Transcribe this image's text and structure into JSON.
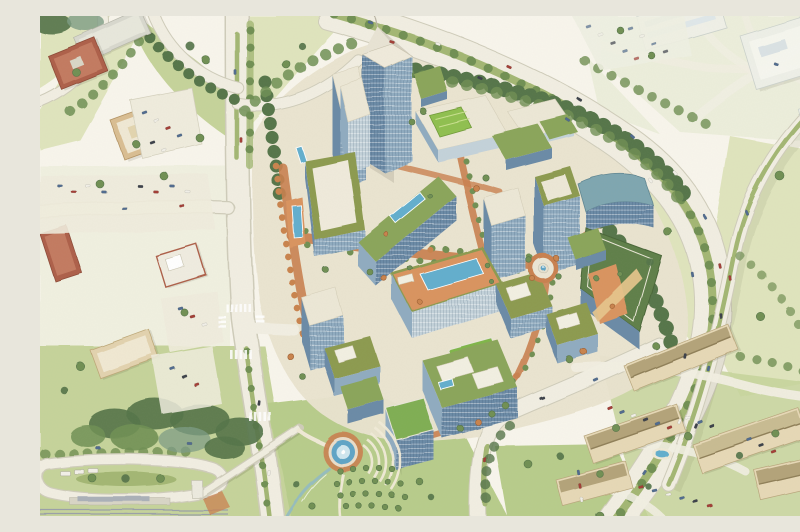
{
  "scene": {
    "title": "Watercolor aerial rendering of a mixed-use urban district master plan",
    "description": "Bird's-eye watercolor illustration of a proposed high-rise mixed-use campus: glass office towers with green roofs and rooftop pools, tree-lined terracotta streets, a roundabout fountain plaza, an amphitheater park with circular pond, orchard grove and stream, bounded by curving freeways with landscaped medians, a divided arterial with crosswalks, a light-rail transit station with pedestrian bridge, surface parking lots with cars, existing brick and glass office buildings to the west and north, and a garden apartment complex to the southeast.",
    "style": "watercolor architectural illustration",
    "view": "aerial oblique"
  },
  "palette": {
    "paper": "#f8f5ec",
    "field": "#dfe4bd",
    "fieldLight": "#eceedb",
    "lawn": "#c5d39a",
    "lawnBright": "#b7cc8b",
    "parkLawn": "#aec77f",
    "treeDark": "#55744a",
    "treeMid": "#6f8f53",
    "treeBlue": "#7d9c84",
    "treeOrange": "#c9834d",
    "road": "#f1eee2",
    "roadEdge": "#cfccba",
    "medianGreen": "#a3b673",
    "terracotta": "#c9804f",
    "deckOrange": "#d9935f",
    "brick": "#ad5f48",
    "tan": "#d9bd92",
    "glassLight": "#c3d2da",
    "glassMid": "#8fabc0",
    "glassDark": "#6b8aa6",
    "glassTeal": "#7ea6b0",
    "roofGreen": "#8aa55a",
    "roofBright": "#7fae52",
    "roofOlive": "#8c9a50",
    "roofDark": "#5e7f48",
    "roofPale": "#ece7d6",
    "pool": "#62aecd",
    "pond": "#5ea4c6",
    "aptWall": "#e6d8b6",
    "aptRoof": "#b3a379",
    "aptRidge": "#8f7f58",
    "carWhite": "#f2f0e8",
    "carBlue": "#4f6b8f",
    "carRed": "#a33c35",
    "carDark": "#3a3f4a",
    "rail": "#9aa0a8"
  },
  "landmarks": [
    {
      "id": "spire-tower",
      "label": "Signature office tower with spire crown"
    },
    {
      "id": "office-towers",
      "label": "Glass office towers with green roofs"
    },
    {
      "id": "rooftop-lap-pool",
      "label": "Rooftop lap pool"
    },
    {
      "id": "central-pool-deck",
      "label": "Rooftop amenity deck with pool and cabanas"
    },
    {
      "id": "roundabout-fountain",
      "label": "Roundabout plaza with fountain"
    },
    {
      "id": "pond-fountain",
      "label": "Circular pond with fountain"
    },
    {
      "id": "amphitheater-lawn",
      "label": "Terraced amphitheater lawn"
    },
    {
      "id": "orchard-grove",
      "label": "Orchard tree grove"
    },
    {
      "id": "stream",
      "label": "Winding stream"
    },
    {
      "id": "campus-streets",
      "label": "Tree-lined terracotta streets"
    },
    {
      "id": "freeway",
      "label": "Curving freeway with landscaped tree median"
    },
    {
      "id": "elevated-ramp",
      "label": "Elevated ramp with planted median"
    },
    {
      "id": "west-arterial",
      "label": "Divided arterial road with crosswalks"
    },
    {
      "id": "light-rail-station",
      "label": "Light-rail station with bus loop"
    },
    {
      "id": "pedestrian-bridge",
      "label": "Pedestrian bridge over arterial"
    },
    {
      "id": "apartment-complex",
      "label": "Garden apartment complex with pool"
    },
    {
      "id": "context-offices",
      "label": "Existing brick and glass offices with parking"
    },
    {
      "id": "tree-canopy",
      "label": "Watercolor tree canopy bands"
    }
  ]
}
